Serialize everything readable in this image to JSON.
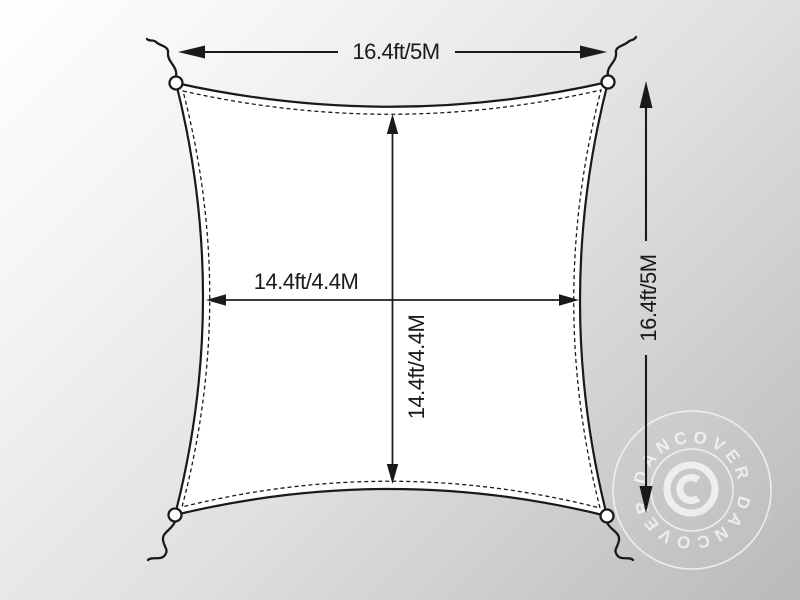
{
  "diagram": {
    "kind": "shade-sail-dimension-diagram",
    "labels": {
      "top_width": "16.4ft/5M",
      "right_height": "16.4ft/5M",
      "inner_width": "14.4ft/4.4M",
      "inner_height": "14.4ft/4.4M"
    }
  },
  "watermark": {
    "brand_top": "DANCOVER",
    "brand_bottom": "DANCOVER",
    "symbol": "©"
  },
  "colors": {
    "line": "#1a1a1a",
    "sail_fill": "#ffffff",
    "watermark": "#ffffff",
    "background_start": "#ffffff",
    "background_end": "#b8babc"
  }
}
